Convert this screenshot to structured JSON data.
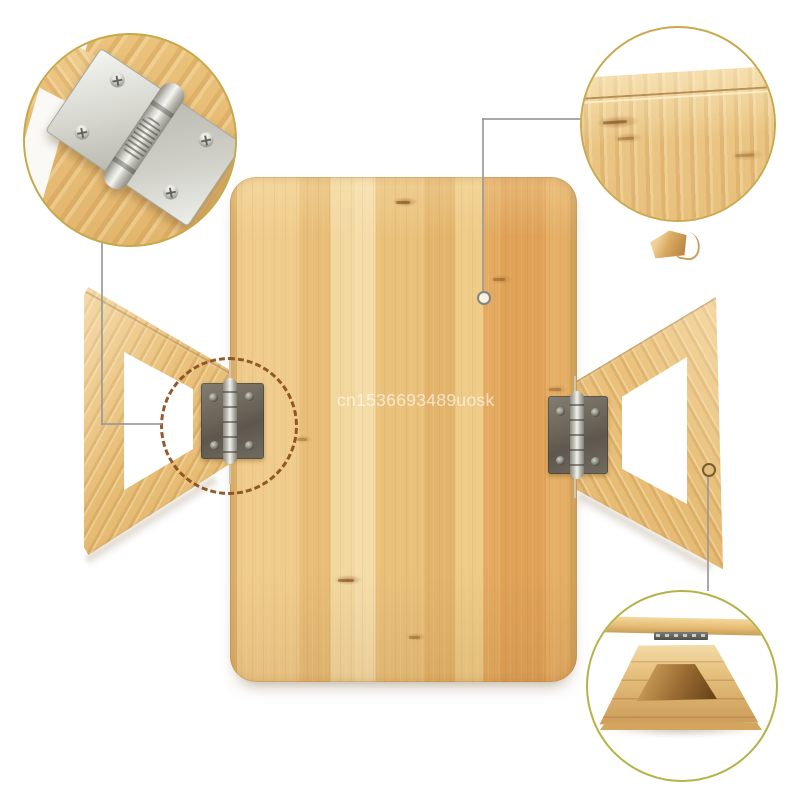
{
  "page": {
    "type": "ecommerce-product-photo",
    "background": "#ffffff",
    "subject": "foldable bamboo table board with two folding trapezoid legs on spring hinges"
  },
  "watermark": {
    "text": "cn1536693489uosk",
    "color": "#ffffff"
  },
  "colors": {
    "bamboo_light": "#f2d79f",
    "bamboo_mid": "#e9c17b",
    "bamboo_orange_panel": "#e0a55d",
    "hinge_plate_dark": "#6b655a",
    "hinge_barrel_silver": "#e8e8e2",
    "chrome_hinge_detail": "#e4e4e0",
    "callout_ring_gold": "#c5a94a",
    "callout_ring_olive": "#b5b249",
    "dotted_marker_brown": "#8a4e1c",
    "connector_gray": "#9a9a98"
  },
  "callouts": {
    "top_left": "spring-hinge-close-up",
    "top_right": "tabletop-corner-groove-close-up",
    "bottom_right": "assembled-table-side-view",
    "dotted_marker": "hinge-location-on-product"
  }
}
